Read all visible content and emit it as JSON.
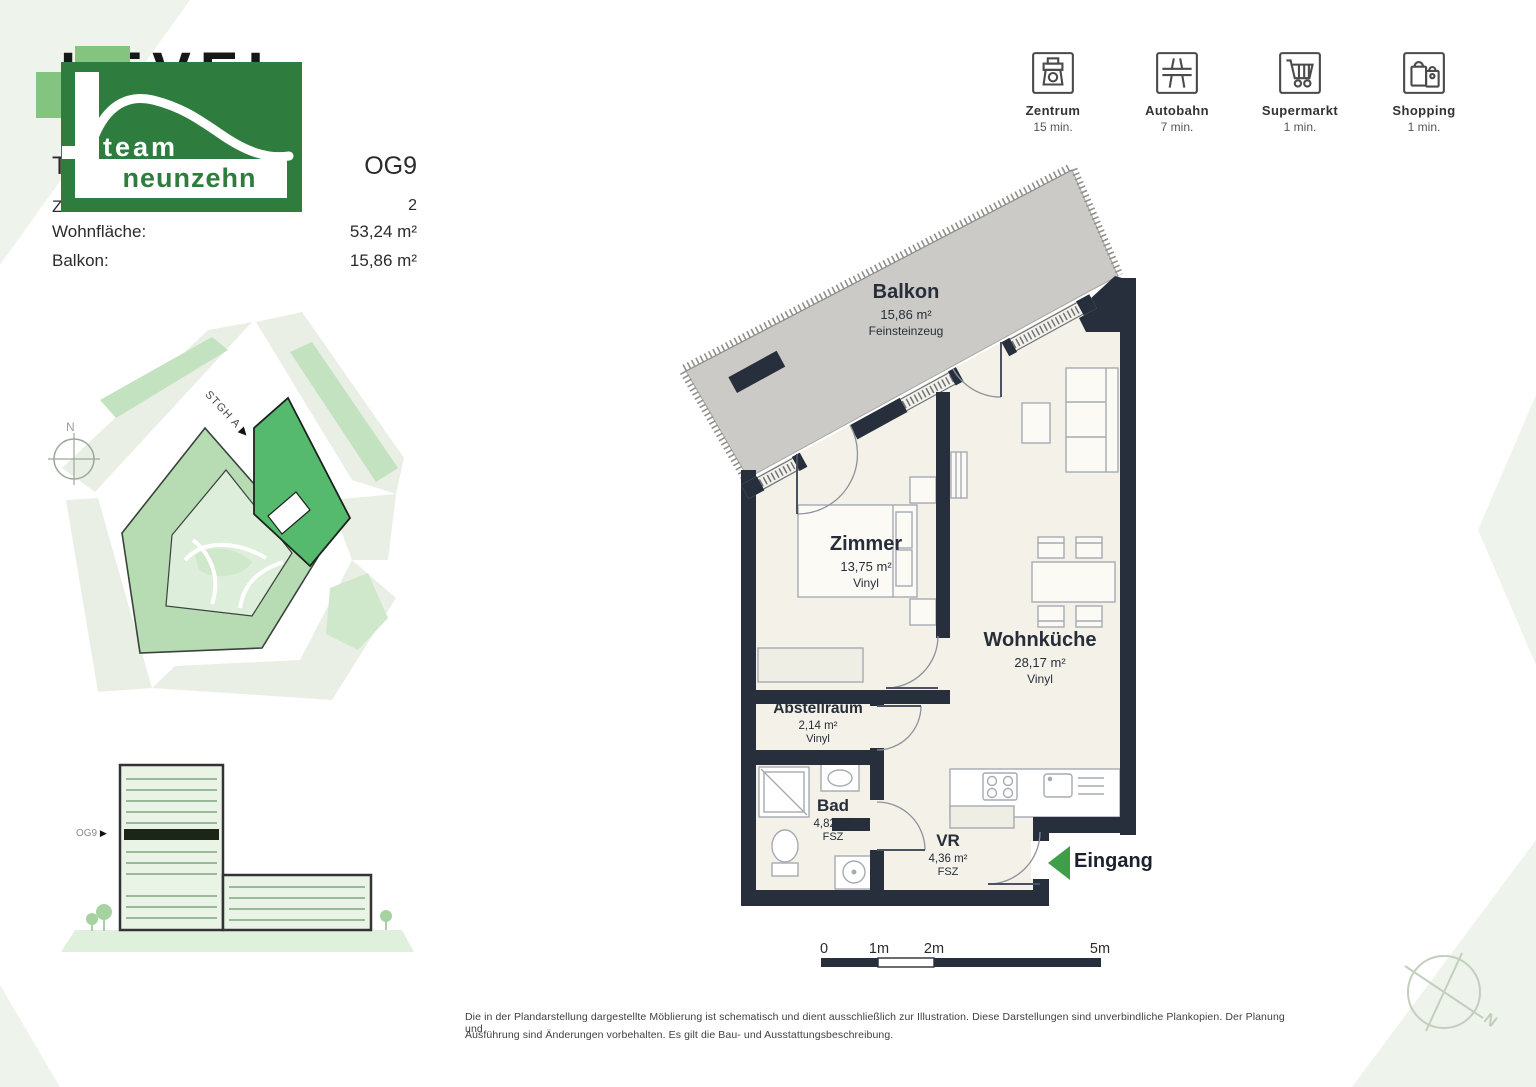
{
  "page": {
    "compass_label": "N"
  },
  "colors": {
    "brand_green": "#2e7d3e",
    "highlight_green": "#55ba6e",
    "wall_navy": "#272e3c",
    "balcony_grey": "#cbcac6",
    "floor_cream": "#f3f1e8",
    "entrance_arrow_green": "#3f9e4a"
  },
  "header": {
    "project_title": "LEVEL",
    "logo": {
      "line1": "team",
      "line2": "neunzehn"
    },
    "rows": [
      {
        "label": "Top:",
        "value": "OG9"
      },
      {
        "label": "Zimmer:",
        "value": "2"
      },
      {
        "label": "Wohnfläche:",
        "value": "53,24 m²"
      },
      {
        "label": "Balkon:",
        "value": "15,86 m²"
      }
    ]
  },
  "amenities": [
    {
      "name": "Zentrum",
      "time": "15 min.",
      "icon": "fountain-icon"
    },
    {
      "name": "Autobahn",
      "time": "7 min.",
      "icon": "overpass-icon"
    },
    {
      "name": "Supermarkt",
      "time": "1 min.",
      "icon": "shopping-cart-icon"
    },
    {
      "name": "Shopping",
      "time": "1 min.",
      "icon": "shopping-bags-icon"
    }
  ],
  "site_plan": {
    "stair_label": "STGH A",
    "stair_arrow": "▶",
    "compass_label": "N"
  },
  "elevation": {
    "floor_label": "OG9",
    "floor_arrow": "▶"
  },
  "floor_plan": {
    "rooms": [
      {
        "name": "Balkon",
        "area": "15,86 m²",
        "floor": "Feinsteinzeug"
      },
      {
        "name": "Zimmer",
        "area": "13,75 m²",
        "floor": "Vinyl"
      },
      {
        "name": "Wohnküche",
        "area": "28,17 m²",
        "floor": "Vinyl"
      },
      {
        "name": "Abstellraum",
        "area": "2,14 m²",
        "floor": "Vinyl"
      },
      {
        "name": "Bad",
        "area": "4,82 m²",
        "floor": "FSZ"
      },
      {
        "name": "VR",
        "area": "4,36 m²",
        "floor": "FSZ"
      }
    ],
    "entrance_label": "Eingang"
  },
  "scale_bar": {
    "labels": [
      "0",
      "1m",
      "2m",
      "5m"
    ]
  },
  "disclaimer": {
    "line1": "Die in der Plandarstellung dargestellte Möblierung ist schematisch und dient ausschließlich zur Illustration. Diese Darstellungen sind unverbindliche Plankopien. Der Planung und",
    "line2": "Ausführung sind Änderungen vorbehalten. Es gilt die Bau- und Ausstattungsbeschreibung."
  }
}
